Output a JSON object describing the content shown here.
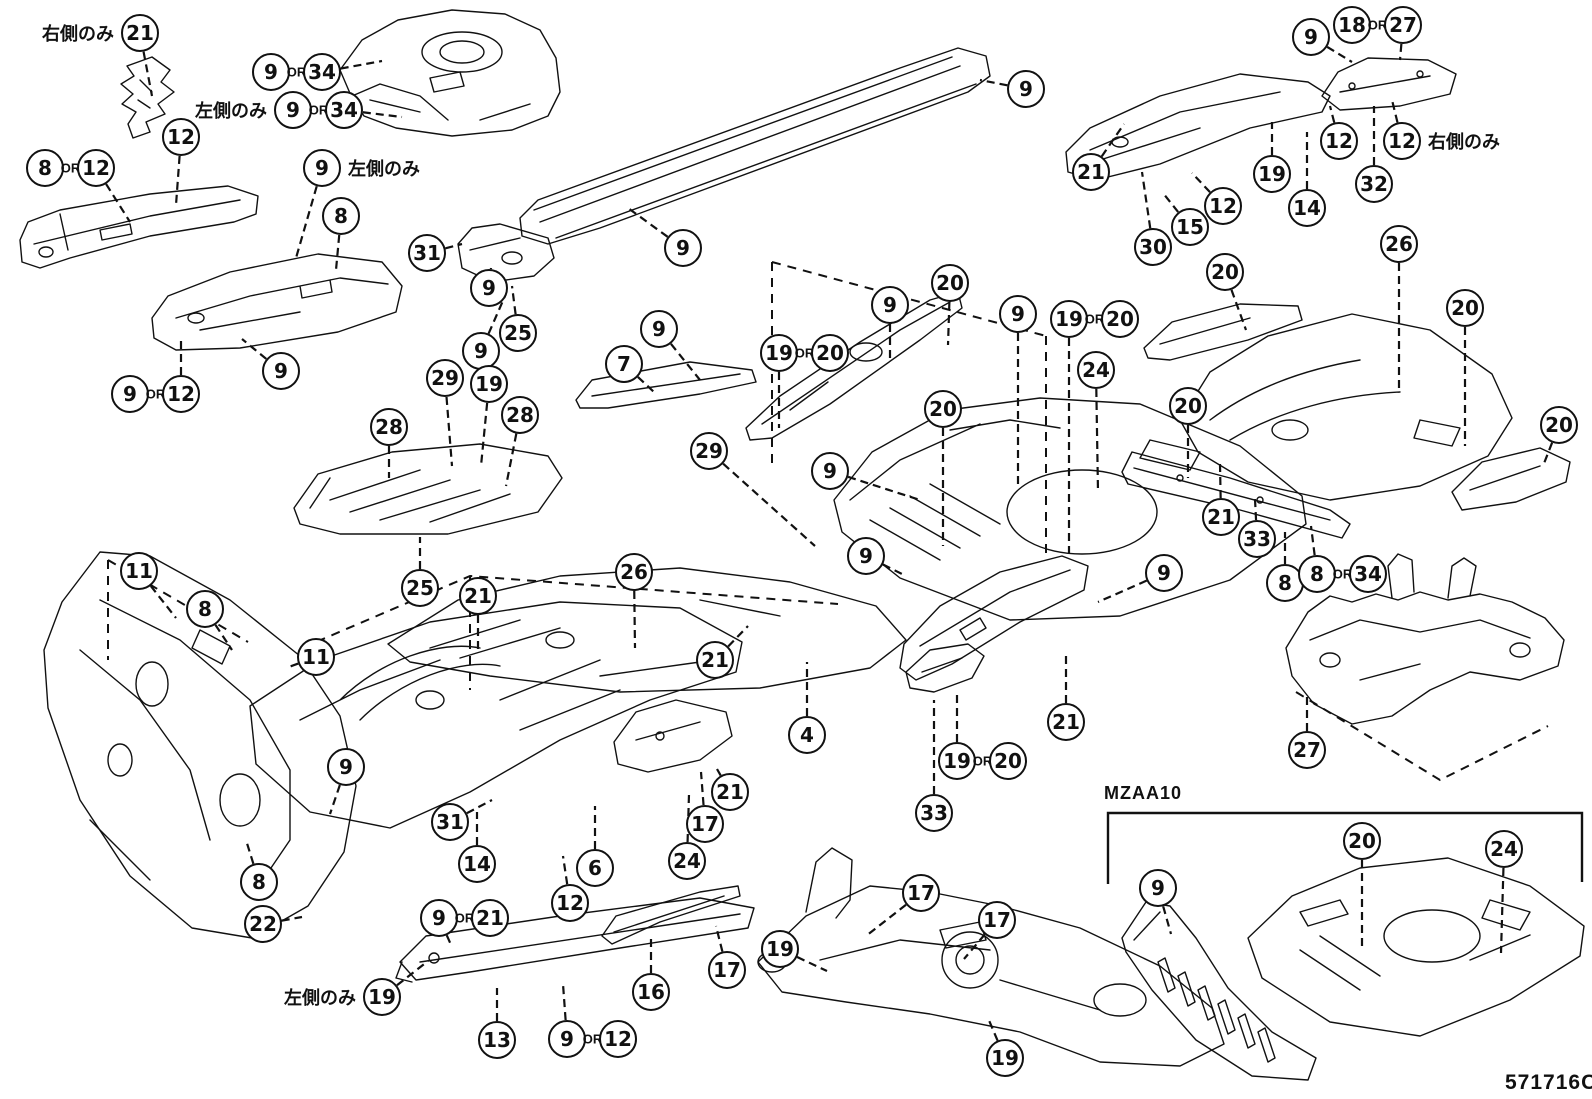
{
  "diagram": {
    "code": "571716C",
    "section_label": "MZAA10",
    "or_text": "OR",
    "note_right_only": "右側のみ",
    "note_left_only": "左側のみ"
  },
  "callouts": [
    {
      "n": "21",
      "x": 140,
      "y": 33,
      "lx": 152,
      "ly": 96,
      "note": "右側のみ",
      "note_side": "left"
    },
    {
      "n": [
        "9",
        "34"
      ],
      "x": 271,
      "y": 72,
      "lx": 382,
      "ly": 61
    },
    {
      "n": [
        "9",
        "34"
      ],
      "x": 293,
      "y": 110,
      "lx": 402,
      "ly": 117,
      "note": "左側のみ",
      "note_side": "left"
    },
    {
      "n": "12",
      "x": 181,
      "y": 137,
      "lx": 176,
      "ly": 205
    },
    {
      "n": [
        "8",
        "12"
      ],
      "x": 45,
      "y": 168,
      "lx": 130,
      "ly": 222
    },
    {
      "n": "9",
      "x": 322,
      "y": 168,
      "lx": 296,
      "ly": 258,
      "note": "左側のみ",
      "note_side": "right"
    },
    {
      "n": "8",
      "x": 341,
      "y": 216,
      "lx": 336,
      "ly": 270
    },
    {
      "n": "31",
      "x": 427,
      "y": 253,
      "lx": 462,
      "ly": 244
    },
    {
      "n": "9",
      "x": 489,
      "y": 288,
      "lx": 491,
      "ly": 268
    },
    {
      "n": "25",
      "x": 518,
      "y": 333,
      "lx": 512,
      "ly": 286
    },
    {
      "n": "9",
      "x": 481,
      "y": 351,
      "lx": 505,
      "ly": 296
    },
    {
      "n": "9",
      "x": 683,
      "y": 248,
      "lx": 628,
      "ly": 208
    },
    {
      "n": "9",
      "x": 1026,
      "y": 89,
      "lx": 980,
      "ly": 80
    },
    {
      "n": "21",
      "x": 1091,
      "y": 172,
      "lx": 1124,
      "ly": 124
    },
    {
      "n": "30",
      "x": 1153,
      "y": 247,
      "lx": 1142,
      "ly": 172
    },
    {
      "n": "15",
      "x": 1190,
      "y": 227,
      "lx": 1163,
      "ly": 193
    },
    {
      "n": "12",
      "x": 1223,
      "y": 206,
      "lx": 1192,
      "ly": 173
    },
    {
      "n": "19",
      "x": 1272,
      "y": 174,
      "lx": 1272,
      "ly": 122
    },
    {
      "n": "14",
      "x": 1307,
      "y": 208,
      "lx": 1307,
      "ly": 132
    },
    {
      "n": "9",
      "x": 1311,
      "y": 37,
      "lx": 1352,
      "ly": 62
    },
    {
      "n": [
        "18",
        "27"
      ],
      "x": 1352,
      "y": 25,
      "lx": 1400,
      "ly": 60
    },
    {
      "n": "12",
      "x": 1339,
      "y": 141,
      "lx": 1330,
      "ly": 106
    },
    {
      "n": "32",
      "x": 1374,
      "y": 184,
      "lx": 1374,
      "ly": 106
    },
    {
      "n": "12",
      "x": 1402,
      "y": 141,
      "lx": 1392,
      "ly": 100,
      "note": "右側のみ",
      "note_side": "right"
    },
    {
      "n": "26",
      "x": 1399,
      "y": 244,
      "lx": 1399,
      "ly": 388
    },
    {
      "n": [
        "9",
        "12"
      ],
      "x": 130,
      "y": 394,
      "lx": 181,
      "ly": 341
    },
    {
      "n": "9",
      "x": 281,
      "y": 371,
      "lx": 242,
      "ly": 339
    },
    {
      "n": "28",
      "x": 389,
      "y": 427,
      "lx": 389,
      "ly": 478
    },
    {
      "n": "29",
      "x": 445,
      "y": 378,
      "lx": 452,
      "ly": 466
    },
    {
      "n": "19",
      "x": 489,
      "y": 384,
      "lx": 481,
      "ly": 466
    },
    {
      "n": "28",
      "x": 520,
      "y": 415,
      "lx": 506,
      "ly": 486
    },
    {
      "n": "7",
      "x": 624,
      "y": 364,
      "lx": 655,
      "ly": 393
    },
    {
      "n": "9",
      "x": 659,
      "y": 329,
      "lx": 700,
      "ly": 380
    },
    {
      "n": [
        "19",
        "20"
      ],
      "x": 779,
      "y": 353,
      "lx": 779,
      "ly": 428
    },
    {
      "n": "9",
      "x": 890,
      "y": 305,
      "lx": 890,
      "ly": 360
    },
    {
      "n": "20",
      "x": 950,
      "y": 283,
      "lx": 948,
      "ly": 345
    },
    {
      "n": "9",
      "x": 1018,
      "y": 314,
      "lx": 1018,
      "ly": 488
    },
    {
      "n": [
        "19",
        "20"
      ],
      "x": 1069,
      "y": 319,
      "lx": 1069,
      "ly": 553
    },
    {
      "n": "24",
      "x": 1096,
      "y": 370,
      "lx": 1098,
      "ly": 492
    },
    {
      "n": "20",
      "x": 943,
      "y": 409,
      "lx": 943,
      "ly": 546
    },
    {
      "n": "9",
      "x": 830,
      "y": 471,
      "lx": 920,
      "ly": 500
    },
    {
      "n": "29",
      "x": 709,
      "y": 451,
      "lx": 815,
      "ly": 546
    },
    {
      "n": "26",
      "x": 634,
      "y": 572,
      "lx": 635,
      "ly": 648
    },
    {
      "n": "21",
      "x": 478,
      "y": 596,
      "lx": 478,
      "ly": 654
    },
    {
      "n": "25",
      "x": 420,
      "y": 588,
      "lx": 420,
      "ly": 537
    },
    {
      "n": "9",
      "x": 866,
      "y": 556,
      "lx": 902,
      "ly": 574
    },
    {
      "n": "9",
      "x": 1164,
      "y": 573,
      "lx": 1098,
      "ly": 602
    },
    {
      "n": "21",
      "x": 715,
      "y": 660,
      "lx": 748,
      "ly": 626
    },
    {
      "n": "4",
      "x": 807,
      "y": 735,
      "lx": 807,
      "ly": 662
    },
    {
      "n": "21",
      "x": 1066,
      "y": 722,
      "lx": 1066,
      "ly": 656
    },
    {
      "n": [
        "19",
        "20"
      ],
      "x": 957,
      "y": 761,
      "lx": 957,
      "ly": 692
    },
    {
      "n": "33",
      "x": 934,
      "y": 813,
      "lx": 934,
      "ly": 700
    },
    {
      "n": "20",
      "x": 1225,
      "y": 272,
      "lx": 1246,
      "ly": 330
    },
    {
      "n": "20",
      "x": 1465,
      "y": 308,
      "lx": 1465,
      "ly": 446
    },
    {
      "n": "20",
      "x": 1188,
      "y": 406,
      "lx": 1188,
      "ly": 478
    },
    {
      "n": "20",
      "x": 1559,
      "y": 425,
      "lx": 1543,
      "ly": 466
    },
    {
      "n": "21",
      "x": 1221,
      "y": 517,
      "lx": 1220,
      "ly": 464
    },
    {
      "n": "33",
      "x": 1257,
      "y": 539,
      "lx": 1255,
      "ly": 499
    },
    {
      "n": "8",
      "x": 1285,
      "y": 583,
      "lx": 1285,
      "ly": 532
    },
    {
      "n": [
        "8",
        "34"
      ],
      "x": 1317,
      "y": 574,
      "lx": 1311,
      "ly": 526
    },
    {
      "n": "27",
      "x": 1307,
      "y": 750,
      "lx": 1307,
      "ly": 694
    },
    {
      "n": "11",
      "x": 139,
      "y": 571,
      "lx": 176,
      "ly": 618
    },
    {
      "n": "8",
      "x": 205,
      "y": 609,
      "lx": 232,
      "ly": 650
    },
    {
      "n": "11",
      "x": 316,
      "y": 657,
      "lx": 286,
      "ly": 668
    },
    {
      "n": "9",
      "x": 346,
      "y": 767,
      "lx": 330,
      "ly": 814
    },
    {
      "n": "8",
      "x": 259,
      "y": 882,
      "lx": 246,
      "ly": 840
    },
    {
      "n": "22",
      "x": 263,
      "y": 924,
      "lx": 302,
      "ly": 917
    },
    {
      "n": "31",
      "x": 450,
      "y": 822,
      "lx": 492,
      "ly": 800
    },
    {
      "n": "14",
      "x": 477,
      "y": 864,
      "lx": 477,
      "ly": 812
    },
    {
      "n": "6",
      "x": 595,
      "y": 868,
      "lx": 595,
      "ly": 806
    },
    {
      "n": "12",
      "x": 570,
      "y": 903,
      "lx": 563,
      "ly": 856
    },
    {
      "n": [
        "9",
        "21"
      ],
      "x": 439,
      "y": 918,
      "lx": 452,
      "ly": 947
    },
    {
      "n": "19",
      "x": 382,
      "y": 997,
      "lx": 428,
      "ly": 961,
      "note": "左側のみ",
      "note_side": "left"
    },
    {
      "n": "13",
      "x": 497,
      "y": 1040,
      "lx": 497,
      "ly": 988
    },
    {
      "n": [
        "9",
        "12"
      ],
      "x": 567,
      "y": 1039,
      "lx": 563,
      "ly": 984
    },
    {
      "n": "16",
      "x": 651,
      "y": 992,
      "lx": 651,
      "ly": 938
    },
    {
      "n": "17",
      "x": 727,
      "y": 970,
      "lx": 716,
      "ly": 926
    },
    {
      "n": "24",
      "x": 687,
      "y": 861,
      "lx": 689,
      "ly": 794
    },
    {
      "n": "17",
      "x": 705,
      "y": 824,
      "lx": 701,
      "ly": 772
    },
    {
      "n": "21",
      "x": 730,
      "y": 792,
      "lx": 717,
      "ly": 769
    },
    {
      "n": "17",
      "x": 921,
      "y": 893,
      "lx": 866,
      "ly": 936
    },
    {
      "n": "19",
      "x": 780,
      "y": 949,
      "lx": 827,
      "ly": 971
    },
    {
      "n": "17",
      "x": 997,
      "y": 920,
      "lx": 964,
      "ly": 959
    },
    {
      "n": "19",
      "x": 1005,
      "y": 1058,
      "lx": 988,
      "ly": 1018
    },
    {
      "n": "9",
      "x": 1158,
      "y": 888,
      "lx": 1171,
      "ly": 934
    },
    {
      "n": "20",
      "x": 1362,
      "y": 841,
      "lx": 1362,
      "ly": 946
    },
    {
      "n": "24",
      "x": 1504,
      "y": 849,
      "lx": 1501,
      "ly": 953
    }
  ]
}
